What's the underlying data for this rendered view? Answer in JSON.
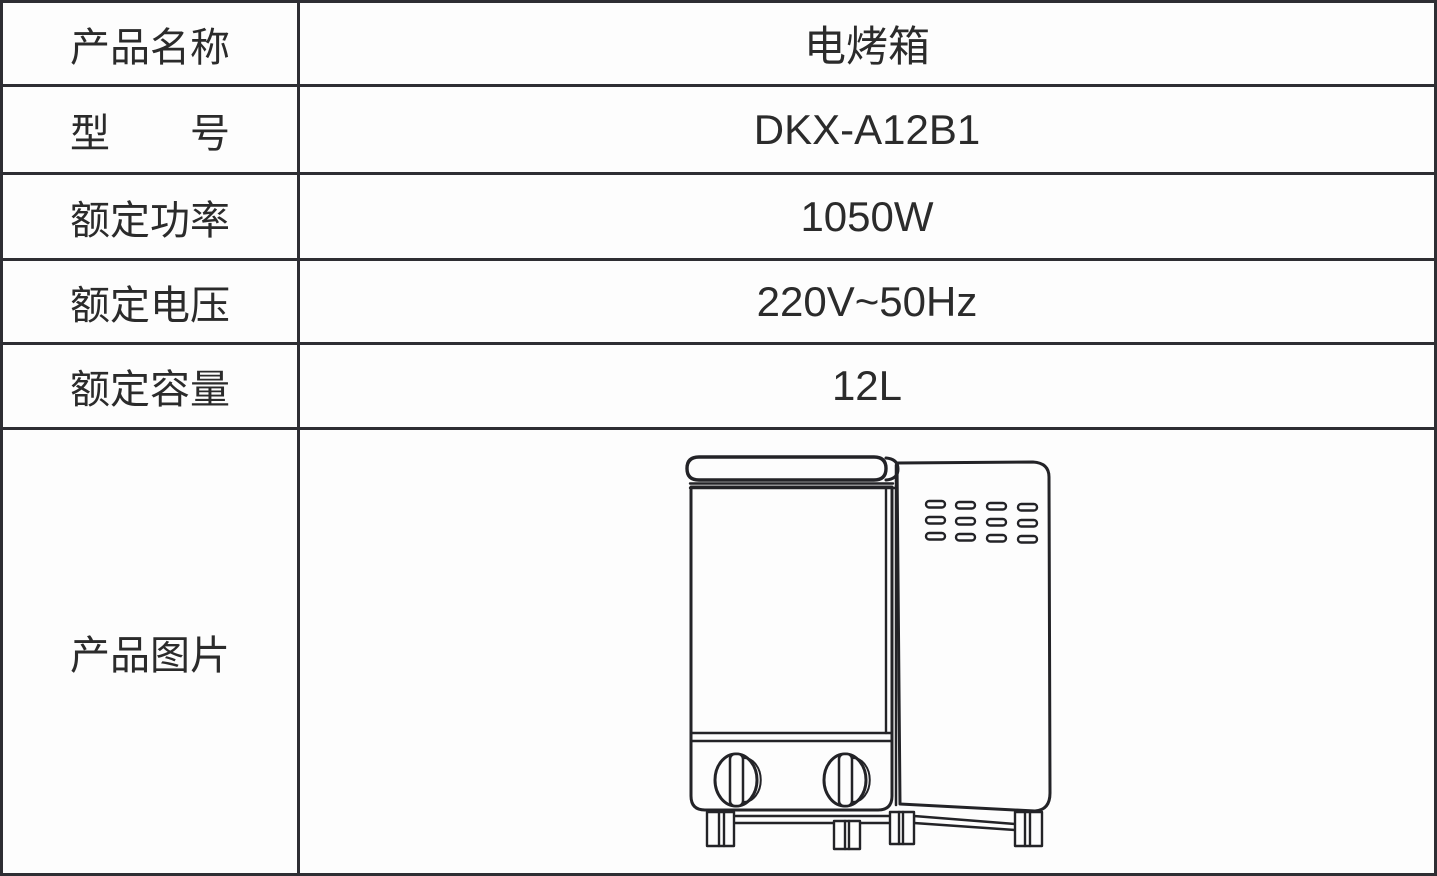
{
  "page": {
    "background_color": "#fdfdfd",
    "border_color": "#2e2e33",
    "text_color": "#2b2b2b",
    "drawing_line_color": "#232327"
  },
  "table": {
    "rows": [
      {
        "label": "产品名称",
        "value": "电烤箱"
      },
      {
        "label": "型　　号",
        "value": "DKX-A12B1"
      },
      {
        "label": "额定功率",
        "value": "1050W"
      },
      {
        "label": "额定电压",
        "value": "220V~50Hz"
      },
      {
        "label": "额定容量",
        "value": "12L"
      }
    ],
    "image_row": {
      "label": "产品图片",
      "image": "electric-oven-line-drawing"
    }
  }
}
